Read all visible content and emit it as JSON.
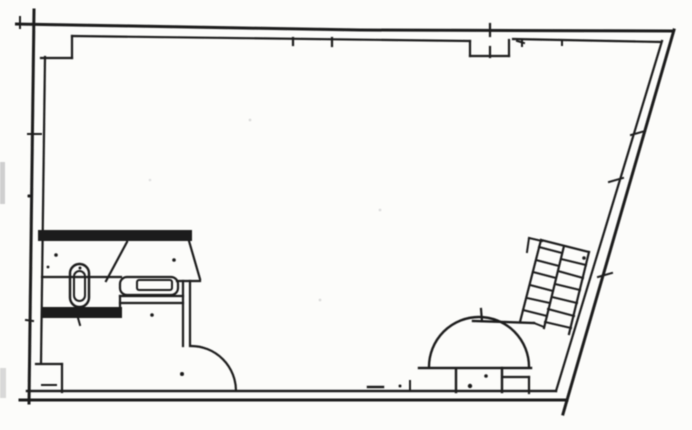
{
  "drawing": {
    "kind": "scanned-floor-plan",
    "colors": {
      "ink": "#1f1f1f",
      "paper": "#fcfcfa",
      "speckle": "#cfcfcf"
    },
    "viewbox": "0 0 692 430",
    "default_w": 2.2,
    "elements": [
      {
        "t": "path",
        "name": "top-wall-outer",
        "d": "M15,24 L360,30 L674,31",
        "w": 3
      },
      {
        "t": "line",
        "name": "top-wall-inner-left",
        "x1": 72,
        "y1": 36,
        "x2": 470,
        "y2": 41,
        "w": 2.2
      },
      {
        "t": "line",
        "name": "top-wall-inner-right",
        "x1": 513,
        "y1": 39,
        "x2": 661,
        "y2": 42,
        "w": 2.2
      },
      {
        "t": "line",
        "name": "corner-pier-vertical",
        "x1": 72,
        "y1": 36,
        "x2": 72,
        "y2": 58,
        "w": 2.2
      },
      {
        "t": "line",
        "name": "corner-pier-horizontal",
        "x1": 41,
        "y1": 58,
        "x2": 72,
        "y2": 58,
        "w": 2.2
      },
      {
        "t": "line",
        "name": "left-wall-outer",
        "x1": 34,
        "y1": 10,
        "x2": 29,
        "y2": 403,
        "w": 3
      },
      {
        "t": "line",
        "name": "left-wall-inner",
        "x1": 45,
        "y1": 57,
        "x2": 41,
        "y2": 363,
        "w": 2.2
      },
      {
        "t": "line",
        "name": "left-base-pier-horizontal",
        "x1": 36,
        "y1": 364,
        "x2": 62,
        "y2": 364,
        "w": 2.2
      },
      {
        "t": "line",
        "name": "left-base-pier-vertical",
        "x1": 62,
        "y1": 364,
        "x2": 62,
        "y2": 392,
        "w": 2.2
      },
      {
        "t": "line",
        "name": "bottom-wall-inner",
        "x1": 27,
        "y1": 391,
        "x2": 556,
        "y2": 391,
        "w": 2.4
      },
      {
        "t": "line",
        "name": "bottom-wall-outer",
        "x1": 20,
        "y1": 400,
        "x2": 567,
        "y2": 400,
        "w": 3
      },
      {
        "t": "line",
        "name": "right-wall-outer",
        "x1": 674,
        "y1": 30,
        "x2": 563,
        "y2": 414,
        "w": 3
      },
      {
        "t": "line",
        "name": "right-wall-inner",
        "x1": 662,
        "y1": 41,
        "x2": 556,
        "y2": 391,
        "w": 2.2
      },
      {
        "t": "line",
        "name": "vent-notch-left",
        "x1": 470,
        "y1": 41,
        "x2": 470,
        "y2": 56,
        "w": 2.2
      },
      {
        "t": "line",
        "name": "vent-notch-bottom",
        "x1": 470,
        "y1": 56,
        "x2": 509,
        "y2": 56,
        "w": 2.2
      },
      {
        "t": "line",
        "name": "vent-notch-right",
        "x1": 509,
        "y1": 56,
        "x2": 509,
        "y2": 40,
        "w": 2.2
      },
      {
        "t": "line",
        "name": "vent-tick-top",
        "x1": 490,
        "y1": 24,
        "x2": 490,
        "y2": 36,
        "w": 2.2
      },
      {
        "t": "line",
        "name": "vent-tick-bottom",
        "x1": 490,
        "y1": 47,
        "x2": 490,
        "y2": 57,
        "w": 2.2
      },
      {
        "t": "line",
        "name": "vent-dash-right",
        "x1": 517,
        "y1": 41,
        "x2": 524,
        "y2": 43,
        "w": 2
      },
      {
        "t": "rect",
        "name": "bathroom-top-wall",
        "x": 38,
        "y": 230,
        "wd": 154,
        "h": 11,
        "fill": true
      },
      {
        "t": "line",
        "name": "bathroom-door-leaf-left",
        "x1": 127,
        "y1": 242,
        "x2": 106,
        "y2": 281,
        "w": 2.2
      },
      {
        "t": "line",
        "name": "bathroom-door-leaf-right",
        "x1": 189,
        "y1": 241,
        "x2": 200,
        "y2": 279,
        "w": 2.2
      },
      {
        "t": "line",
        "name": "bathroom-shelf-line",
        "x1": 42,
        "y1": 277,
        "x2": 121,
        "y2": 277,
        "w": 2.2
      },
      {
        "t": "rect",
        "name": "sink-outline",
        "x": 120,
        "y": 277,
        "wd": 58,
        "h": 18,
        "r": 7,
        "w": 2.2
      },
      {
        "t": "rect",
        "name": "sink-basin",
        "x": 137,
        "y": 280,
        "wd": 35,
        "h": 10,
        "r": 2,
        "w": 2
      },
      {
        "t": "line",
        "name": "bathroom-bracket",
        "x1": 177,
        "y1": 281,
        "x2": 200,
        "y2": 281,
        "w": 2.2
      },
      {
        "t": "line",
        "name": "bathroom-wall-vertical-1",
        "x1": 183,
        "y1": 281,
        "x2": 183,
        "y2": 346,
        "w": 2.2
      },
      {
        "t": "line",
        "name": "bathroom-wall-vertical-2",
        "x1": 190,
        "y1": 281,
        "x2": 190,
        "y2": 346,
        "w": 2.2
      },
      {
        "t": "line",
        "name": "bathroom-wall-horizontal-1",
        "x1": 120,
        "y1": 296,
        "x2": 183,
        "y2": 296,
        "w": 2.2
      },
      {
        "t": "line",
        "name": "bathroom-wall-horizontal-2",
        "x1": 120,
        "y1": 303,
        "x2": 183,
        "y2": 303,
        "w": 2.2
      },
      {
        "t": "line",
        "name": "bathroom-wall-step",
        "x1": 120,
        "y1": 296,
        "x2": 120,
        "y2": 308,
        "w": 2.2
      },
      {
        "t": "rect",
        "name": "bathroom-bottom-wall",
        "x": 41,
        "y": 307,
        "wd": 81,
        "h": 11,
        "fill": true
      },
      {
        "t": "path",
        "name": "bathroom-door-arc",
        "d": "M191,346 A45,45 0 0 1 236,391",
        "w": 2.2
      },
      {
        "t": "rect",
        "name": "toilet-outline",
        "x": 70,
        "y": 264,
        "wd": 19,
        "h": 43,
        "r": 9.5,
        "w": 2.4
      },
      {
        "t": "rect",
        "name": "toilet-bowl",
        "x": 74,
        "y": 271,
        "wd": 11,
        "h": 30,
        "r": 5.5,
        "w": 2
      },
      {
        "t": "dot",
        "name": "toilet-dot",
        "cx": 80,
        "cy": 268,
        "rr": 1.5
      },
      {
        "t": "path",
        "name": "entry-door-arc",
        "d": "M429,367 A50,50 0 0 1 529,367",
        "w": 2.4
      },
      {
        "t": "line",
        "name": "entry-threshold",
        "x1": 419,
        "y1": 368,
        "x2": 531,
        "y2": 368,
        "w": 2.4
      },
      {
        "t": "line",
        "name": "entry-jamb-left",
        "x1": 456,
        "y1": 370,
        "x2": 456,
        "y2": 392,
        "w": 2.4
      },
      {
        "t": "line",
        "name": "entry-jamb-right",
        "x1": 502,
        "y1": 368,
        "x2": 502,
        "y2": 392,
        "w": 2.4
      },
      {
        "t": "line",
        "name": "entry-pier-horizontal",
        "x1": 502,
        "y1": 377,
        "x2": 529,
        "y2": 377,
        "w": 2.2
      },
      {
        "t": "line",
        "name": "entry-pier-vertical",
        "x1": 529,
        "y1": 377,
        "x2": 529,
        "y2": 393,
        "w": 2.2
      },
      {
        "t": "dot",
        "name": "entry-dot-1",
        "cx": 470,
        "cy": 386,
        "rr": 2.2
      },
      {
        "t": "dot",
        "name": "entry-dot-2",
        "cx": 486,
        "cy": 376,
        "rr": 1.8
      },
      {
        "t": "line",
        "name": "understair-wall",
        "x1": 473,
        "y1": 321,
        "x2": 534,
        "y2": 323,
        "w": 2.4
      },
      {
        "t": "line",
        "name": "understair-tick",
        "x1": 481,
        "y1": 309,
        "x2": 482,
        "y2": 321,
        "w": 2.2
      },
      {
        "t": "line",
        "name": "understair-join",
        "x1": 534,
        "y1": 323,
        "x2": 544,
        "y2": 327,
        "w": 2
      },
      {
        "t": "line",
        "name": "stair-rail-left",
        "x1": 541,
        "y1": 240,
        "x2": 520,
        "y2": 322,
        "w": 2.2
      },
      {
        "t": "line",
        "name": "stair-rail-middle",
        "x1": 564,
        "y1": 246,
        "x2": 544,
        "y2": 328,
        "w": 2.2
      },
      {
        "t": "line",
        "name": "stair-rail-right",
        "x1": 589,
        "y1": 252,
        "x2": 569,
        "y2": 334,
        "w": 2.2
      },
      {
        "t": "line",
        "name": "stair-top-cap",
        "x1": 541,
        "y1": 240,
        "x2": 589,
        "y2": 252,
        "w": 2.2
      },
      {
        "t": "line",
        "name": "stair-top-extension",
        "x1": 529,
        "y1": 238,
        "x2": 542,
        "y2": 241,
        "w": 2
      },
      {
        "t": "line",
        "name": "stair-top-hook",
        "x1": 529,
        "y1": 238,
        "x2": 527,
        "y2": 252,
        "w": 2
      },
      {
        "t": "line",
        "name": "stair-tread-r1",
        "x1": 561,
        "y1": 259,
        "x2": 586,
        "y2": 265,
        "w": 2
      },
      {
        "t": "line",
        "name": "stair-tread-r2",
        "x1": 558,
        "y1": 271,
        "x2": 583,
        "y2": 278,
        "w": 2
      },
      {
        "t": "line",
        "name": "stair-tread-r3",
        "x1": 555,
        "y1": 284,
        "x2": 580,
        "y2": 290,
        "w": 2
      },
      {
        "t": "line",
        "name": "stair-tread-r4",
        "x1": 552,
        "y1": 297,
        "x2": 577,
        "y2": 303,
        "w": 2
      },
      {
        "t": "line",
        "name": "stair-tread-r5",
        "x1": 548,
        "y1": 309,
        "x2": 574,
        "y2": 316,
        "w": 2
      },
      {
        "t": "line",
        "name": "stair-tread-r6",
        "x1": 545,
        "y1": 322,
        "x2": 571,
        "y2": 328,
        "w": 2
      },
      {
        "t": "line",
        "name": "stair-tread-l1",
        "x1": 539,
        "y1": 247,
        "x2": 562,
        "y2": 253,
        "w": 2
      },
      {
        "t": "line",
        "name": "stair-tread-l2",
        "x1": 536,
        "y1": 260,
        "x2": 559,
        "y2": 266,
        "w": 2
      },
      {
        "t": "line",
        "name": "stair-tread-l3",
        "x1": 533,
        "y1": 272,
        "x2": 556,
        "y2": 278,
        "w": 2
      },
      {
        "t": "line",
        "name": "stair-tread-l4",
        "x1": 530,
        "y1": 285,
        "x2": 553,
        "y2": 291,
        "w": 2
      },
      {
        "t": "line",
        "name": "stair-tread-l5",
        "x1": 527,
        "y1": 298,
        "x2": 550,
        "y2": 303,
        "w": 2
      },
      {
        "t": "line",
        "name": "stair-tread-l6",
        "x1": 523,
        "y1": 310,
        "x2": 547,
        "y2": 316,
        "w": 2
      },
      {
        "t": "line",
        "name": "top-tick-1",
        "x1": 293,
        "y1": 38,
        "x2": 293,
        "y2": 45,
        "w": 2.2
      },
      {
        "t": "line",
        "name": "top-tick-2",
        "x1": 332,
        "y1": 38,
        "x2": 332,
        "y2": 46,
        "w": 2.2
      },
      {
        "t": "line",
        "name": "top-tick-3",
        "x1": 522,
        "y1": 40,
        "x2": 522,
        "y2": 46,
        "w": 2
      },
      {
        "t": "line",
        "name": "top-tick-4",
        "x1": 562,
        "y1": 40,
        "x2": 562,
        "y2": 45,
        "w": 2
      },
      {
        "t": "line",
        "name": "top-left-tick",
        "x1": 20,
        "y1": 17,
        "x2": 20,
        "y2": 28,
        "w": 2
      },
      {
        "t": "line",
        "name": "left-wall-tick-1",
        "x1": 28,
        "y1": 134,
        "x2": 41,
        "y2": 134,
        "w": 2
      },
      {
        "t": "dot",
        "name": "left-wall-dot",
        "cx": 29,
        "cy": 196,
        "rr": 1.6
      },
      {
        "t": "line",
        "name": "left-wall-tick-2",
        "x1": 26,
        "y1": 320,
        "x2": 33,
        "y2": 321,
        "w": 2
      },
      {
        "t": "dot",
        "name": "bath-dot-1",
        "cx": 56,
        "cy": 255,
        "rr": 1.8
      },
      {
        "t": "dot",
        "name": "bath-dot-2",
        "cx": 48,
        "cy": 267,
        "rr": 1.4
      },
      {
        "t": "dot",
        "name": "bath-dot-3",
        "cx": 174,
        "cy": 260,
        "rr": 1.8
      },
      {
        "t": "dot",
        "name": "bath-dot-4",
        "cx": 152,
        "cy": 315,
        "rr": 1.8
      },
      {
        "t": "line",
        "name": "bath-band-tick",
        "x1": 78,
        "y1": 318,
        "x2": 80,
        "y2": 325,
        "w": 2
      },
      {
        "t": "dot",
        "name": "room-dot",
        "cx": 182,
        "cy": 374,
        "rr": 2
      },
      {
        "t": "line",
        "name": "bottom-wall-tick",
        "x1": 410,
        "y1": 381,
        "x2": 410,
        "y2": 391,
        "w": 2
      },
      {
        "t": "line",
        "name": "bottom-wall-dash",
        "x1": 368,
        "y1": 387,
        "x2": 383,
        "y2": 387,
        "w": 2.5
      },
      {
        "t": "line",
        "name": "bottom-left-dash",
        "x1": 42,
        "y1": 385,
        "x2": 56,
        "y2": 385,
        "w": 2
      },
      {
        "t": "dot",
        "name": "bottom-wall-dot",
        "cx": 400,
        "cy": 386,
        "rr": 1.5
      },
      {
        "t": "dot",
        "name": "stair-dot",
        "cx": 584,
        "cy": 258,
        "rr": 1.8
      },
      {
        "t": "line",
        "name": "right-wall-tick-1",
        "x1": 631,
        "y1": 135,
        "x2": 645,
        "y2": 131,
        "w": 2
      },
      {
        "t": "line",
        "name": "right-wall-tick-2",
        "x1": 609,
        "y1": 182,
        "x2": 623,
        "y2": 178,
        "w": 2
      },
      {
        "t": "line",
        "name": "right-wall-tick-3",
        "x1": 598,
        "y1": 277,
        "x2": 612,
        "y2": 273,
        "w": 2
      },
      {
        "t": "rect",
        "name": "scan-smudge-1",
        "x": 0,
        "y": 162,
        "wd": 5,
        "h": 42,
        "fill": "#cfcfcf"
      },
      {
        "t": "rect",
        "name": "scan-smudge-2",
        "x": 0,
        "y": 368,
        "wd": 6,
        "h": 30,
        "fill": "#d8d8d8"
      },
      {
        "t": "dot",
        "name": "scan-speckle-1",
        "cx": 250,
        "cy": 120,
        "rr": 1.4,
        "c": "#dcdcdc"
      },
      {
        "t": "dot",
        "name": "scan-speckle-2",
        "cx": 380,
        "cy": 210,
        "rr": 1.4,
        "c": "#dedede"
      },
      {
        "t": "dot",
        "name": "scan-speckle-3",
        "cx": 320,
        "cy": 300,
        "rr": 1.4,
        "c": "#dcdcdc"
      },
      {
        "t": "dot",
        "name": "scan-speckle-4",
        "cx": 150,
        "cy": 180,
        "rr": 1.3,
        "c": "#e0e0e0"
      }
    ]
  }
}
